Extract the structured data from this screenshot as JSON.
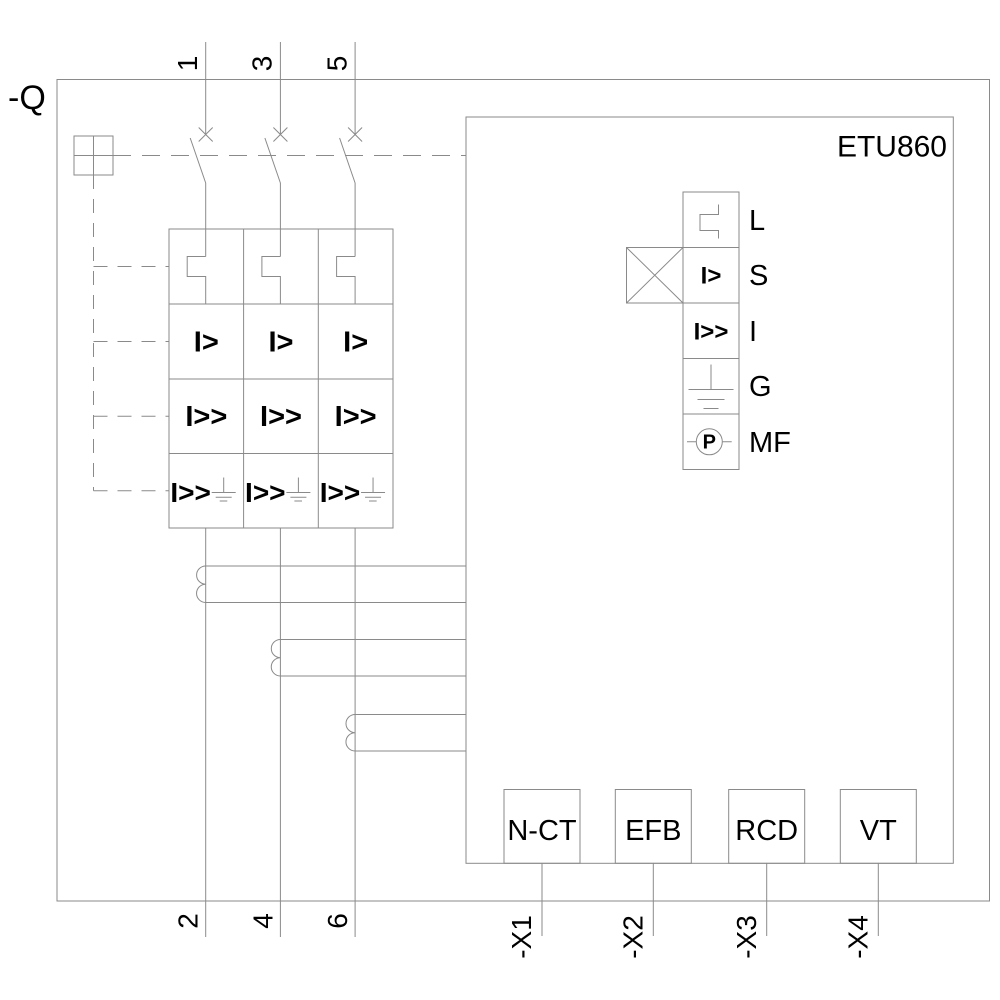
{
  "device": {
    "tag": "-Q",
    "trip_unit": "ETU860"
  },
  "pole_terminals": {
    "top": [
      "1",
      "3",
      "5"
    ],
    "bottom": [
      "2",
      "4",
      "6"
    ]
  },
  "protection_grid": {
    "overload": "I>",
    "short_circuit": "I>>",
    "ground_fault": "I>>"
  },
  "legend": {
    "items": [
      {
        "id": "L",
        "label": "L"
      },
      {
        "id": "S",
        "label": "S",
        "symbol": "I>"
      },
      {
        "id": "I",
        "label": "I",
        "symbol": "I>>"
      },
      {
        "id": "G",
        "label": "G"
      },
      {
        "id": "MF",
        "label": "MF",
        "symbol": "P"
      }
    ]
  },
  "modules": [
    {
      "label": "N-CT",
      "terminal": "-X1"
    },
    {
      "label": "EFB",
      "terminal": "-X2"
    },
    {
      "label": "RCD",
      "terminal": "-X3"
    },
    {
      "label": "VT",
      "terminal": "-X4"
    }
  ]
}
